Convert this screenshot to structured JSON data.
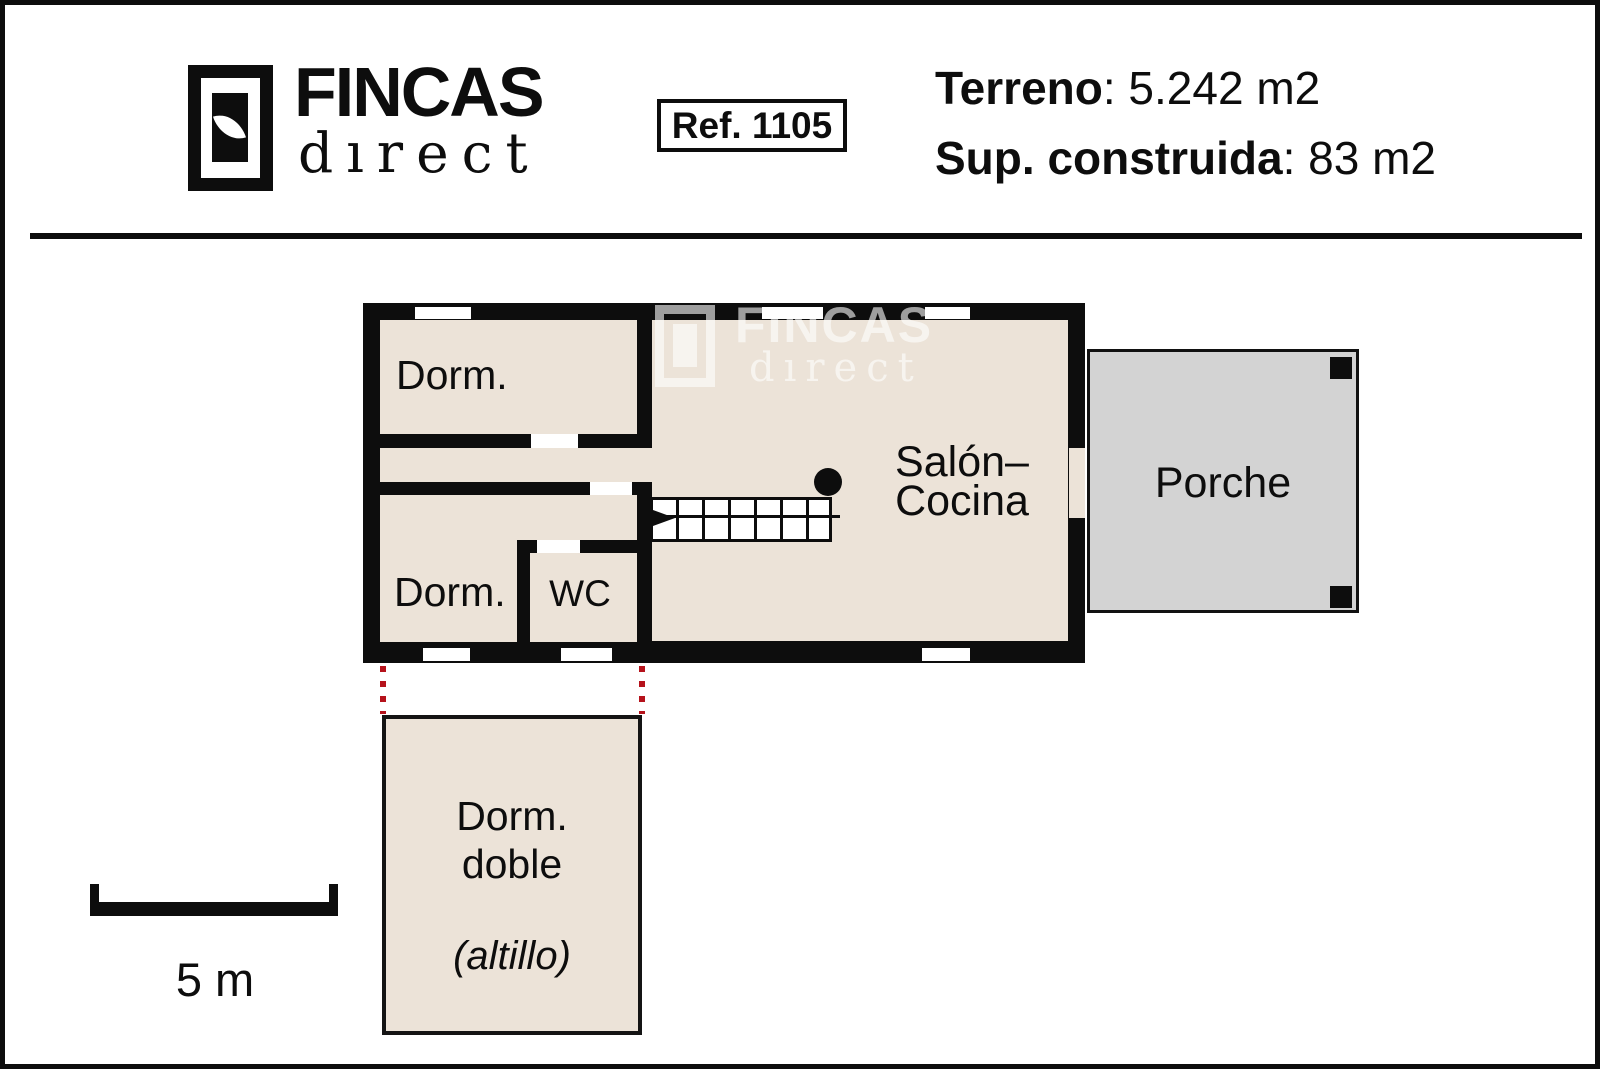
{
  "header": {
    "brand_name": "FINCAS",
    "brand_sub": "dırect",
    "ref": "Ref. 1105",
    "terreno": {
      "label": "Terreno",
      "value": ": 5.242 m2"
    },
    "sup": {
      "label": "Sup. construida",
      "value": ": 83 m2"
    }
  },
  "watermark": {
    "brand_name": "FINCAS",
    "brand_sub": "dırect"
  },
  "plan": {
    "rooms": {
      "dorm_top": "Dorm.",
      "dorm_bottom": "Dorm.",
      "wc": "WC",
      "salon_line1": "Salón–",
      "salon_line2": "Cocina",
      "porche": "Porche"
    },
    "annex": {
      "line1": "Dorm.",
      "line2": "doble",
      "line3": "(altillo)"
    }
  },
  "scale_bar": {
    "label": "5 m"
  },
  "colors": {
    "wall": "#0d0d0d",
    "room_fill": "#ece3d8",
    "porch_fill": "#d3d3d3",
    "projection_dots": "#b5121b"
  }
}
